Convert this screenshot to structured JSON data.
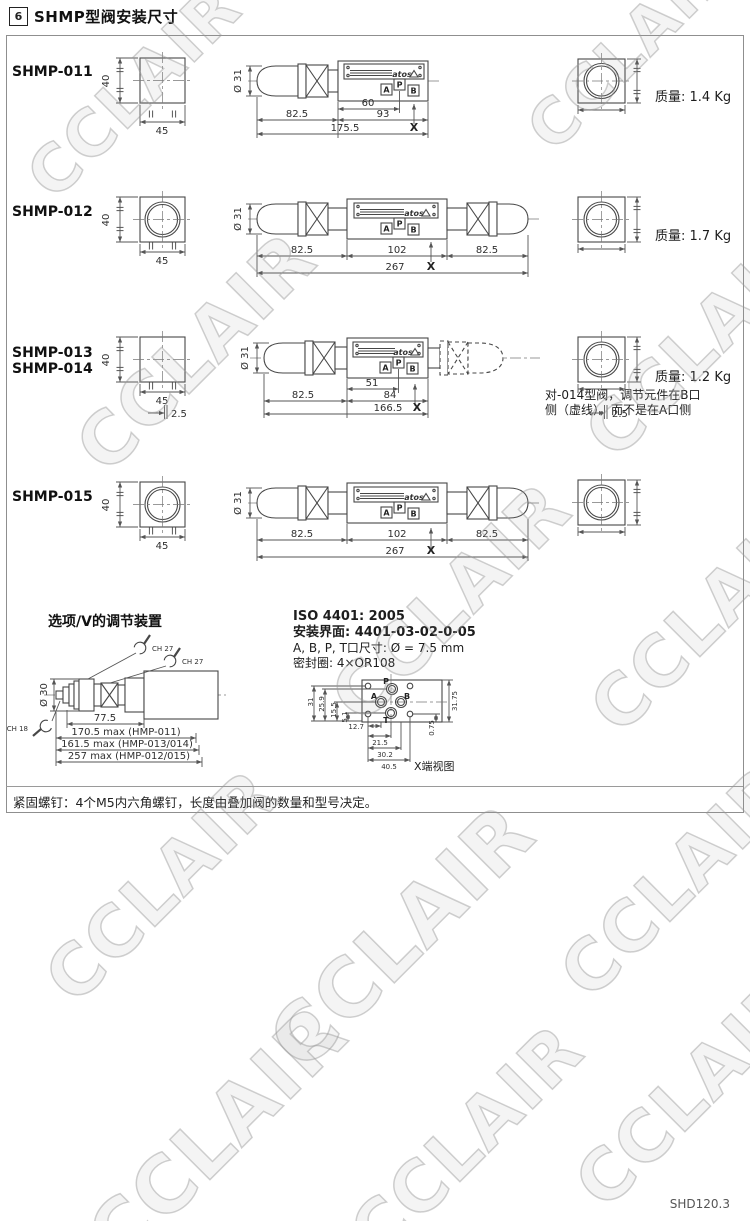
{
  "header": {
    "num": "6",
    "title": "SHMP型阀安装尺寸"
  },
  "watermark": "CCLAIR",
  "brand": "atos",
  "rows": [
    {
      "models": [
        "SHMP-011"
      ],
      "front": {
        "h": "40",
        "w": "45"
      },
      "diameter": "Ø 31",
      "ports": {
        "a": "A",
        "p": "P",
        "b": "B"
      },
      "dims": {
        "d1": "60",
        "d2": "93",
        "d3": "82.5",
        "total": "175.5"
      },
      "x": "X",
      "weight": "质量: 1.4 Kg"
    },
    {
      "models": [
        "SHMP-012"
      ],
      "front": {
        "h": "40",
        "w": "45"
      },
      "diameter": "Ø 31",
      "ports": {
        "a": "A",
        "p": "P",
        "b": "B"
      },
      "dims": {
        "left": "82.5",
        "mid": "102",
        "right": "82.5",
        "total": "267"
      },
      "x": "X",
      "weight": "质量: 1.7 Kg"
    },
    {
      "models": [
        "SHMP-013",
        "SHMP-014"
      ],
      "front": {
        "h": "40",
        "w": "45",
        "offset": "2.5"
      },
      "diameter": "Ø 31",
      "ports": {
        "a": "A",
        "p": "P",
        "b": "B"
      },
      "dims": {
        "d1": "51",
        "d2": "84",
        "d3": "82.5",
        "total": "166.5"
      },
      "x": "X",
      "end_offset": "2.5",
      "note_line1": "对-014型阀，调节元件在B口",
      "note_line2": "侧（虚线），而不是在A口侧",
      "weight": "质量: 1.2 Kg"
    },
    {
      "models": [
        "SHMP-015"
      ],
      "front": {
        "h": "40",
        "w": "45"
      },
      "diameter": "Ø 31",
      "ports": {
        "a": "A",
        "p": "P",
        "b": "B"
      },
      "dims": {
        "left": "82.5",
        "mid": "102",
        "right": "82.5",
        "total": "267"
      },
      "x": "X"
    }
  ],
  "option_section": {
    "title": "选项/V的调节装置",
    "diameter": "Ø 30",
    "ch27a": "CH 27",
    "ch27b": "CH 27",
    "ch18": "CH 18",
    "base_dim": "77.5",
    "lengths": [
      "170.5 max (HMP-011)",
      "161.5 max (HMP-013/014)",
      "257 max (HMP-012/015)"
    ]
  },
  "iso_section": {
    "title": "ISO 4401: 2005",
    "surface": "安装界面: 4401-03-02-0-05",
    "ports_size": "A, B, P, T口尺寸: Ø = 7.5 mm",
    "seal": "密封圈: 4×OR108",
    "ports": {
      "p": "P",
      "a": "A",
      "b": "B",
      "t": "T"
    },
    "dims": {
      "h31": "31",
      "h259": "25.9",
      "h155": "15.5",
      "h51": "5.1",
      "w127": "12.7",
      "w215": "21.5",
      "w302": "30.2",
      "w405": "40.5",
      "r3175": "31.75",
      "r075": "0.75"
    },
    "view_label": "X端视图"
  },
  "bottom_note": "紧固螺钉：4个M5内六角螺钉，长度由叠加阀的数量和型号决定。",
  "doc_code": "SHD120.3"
}
